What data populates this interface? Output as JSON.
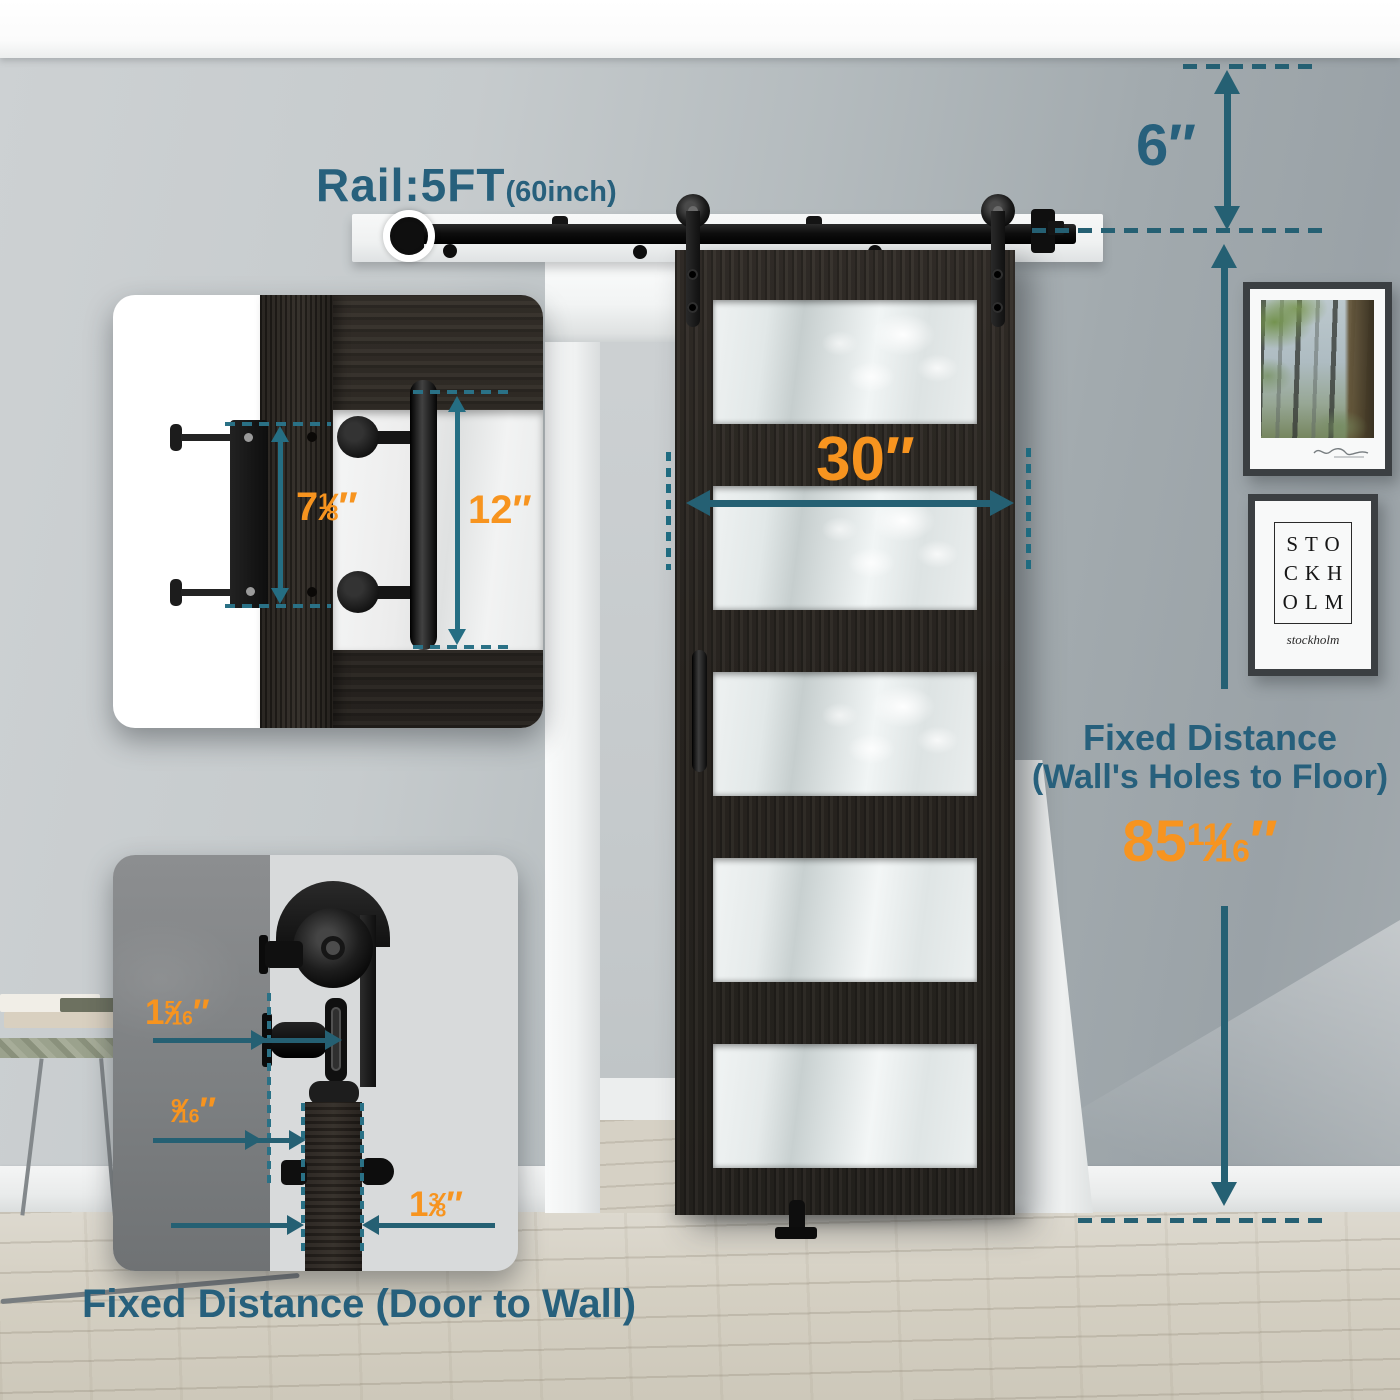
{
  "colors": {
    "teal": "#256073",
    "orange": "#f7941f",
    "door_wood": "#2c2824",
    "rail_black": "#0e0e0e",
    "wall_gray": "#b4bbbe"
  },
  "labels": {
    "rail": {
      "main": "Rail:5FT",
      "sub": "(60inch)"
    },
    "top_gap": "6″",
    "door_width": "30″",
    "handle_length": "12″",
    "plate_height": {
      "whole": "7",
      "num": "1",
      "slash": "⁄",
      "den": "8",
      "unit": "″"
    },
    "right_block": {
      "line1": "Fixed Distance",
      "line2": "(Wall's Holes to Floor)"
    },
    "right_value": {
      "whole": "85",
      "num": "11",
      "slash": "⁄",
      "den": "16",
      "unit": "″"
    },
    "gap_wall_rail": {
      "whole": "1",
      "num": "5",
      "slash": "⁄",
      "den": "16",
      "unit": "″"
    },
    "gap_rail_door": {
      "whole": "",
      "num": "9",
      "slash": "⁄",
      "den": "16",
      "unit": "″"
    },
    "door_thickness": {
      "whole": "1",
      "num": "3",
      "slash": "⁄",
      "den": "8",
      "unit": "″"
    },
    "bottom_caption": "Fixed Distance (Door to Wall)"
  },
  "poster": {
    "lines": [
      "STO",
      "CKH",
      "OLM"
    ],
    "script": "stockholm"
  }
}
